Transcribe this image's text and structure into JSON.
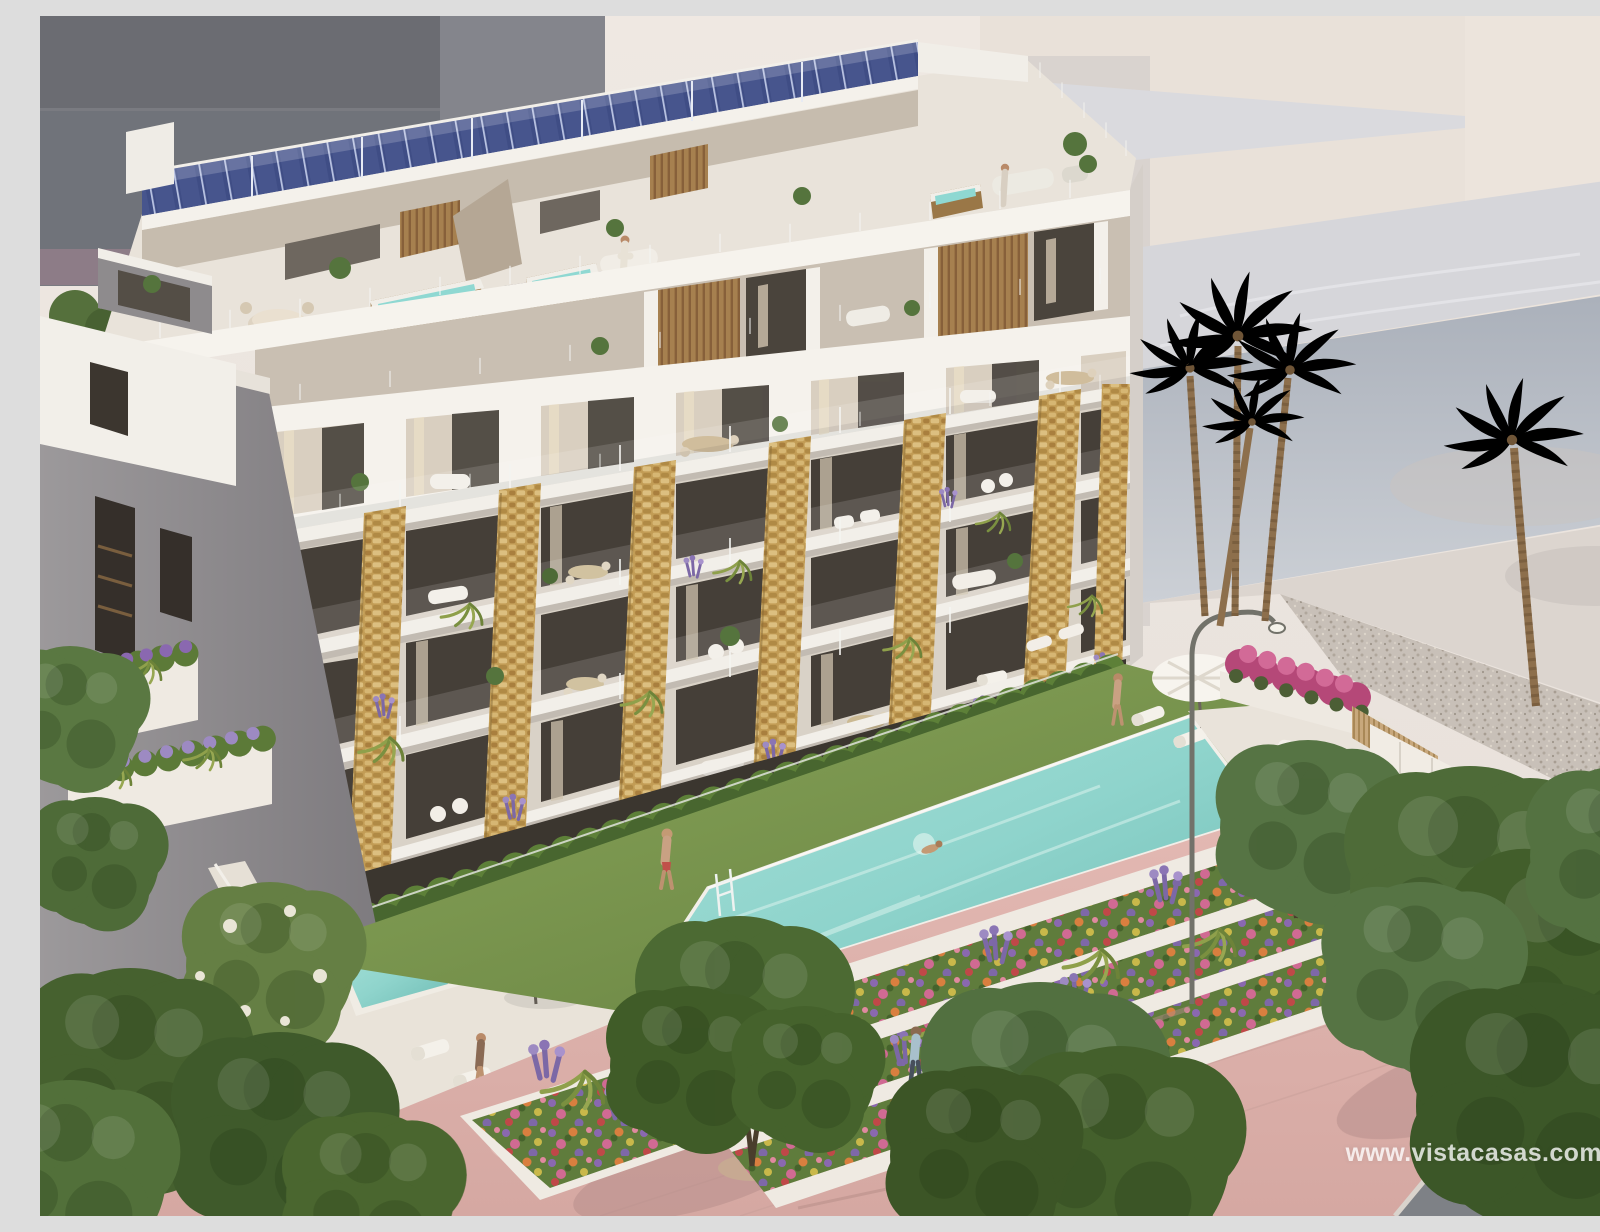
{
  "watermark": {
    "text": "www.vistacasas.com"
  },
  "palette": {
    "sky": "#ece5df",
    "bgDarkBuilding": "#7a7b81",
    "bgCream": "#e9e1d9",
    "roofMarble": "#d6d6da",
    "shadowFaceTop": "#aeb3bd",
    "shadowFaceBottom": "#ccd0d6",
    "plaza": "#dcd5cf",
    "gravel": "#c8c0b8",
    "buildingWhite": "#f5f2ec",
    "facadeWall": "#d9d2c7",
    "windowVoid": "#453f38",
    "stoneGold": "#c29c55",
    "solarBlue": "#3f4d85",
    "poolTurquoise": "#8fd4cc",
    "lawnGreen": "#7d9a52",
    "hedgeGreen": "#48662f",
    "promenadePink": "#dfb5b0",
    "roadGrey": "#7e8186",
    "treeGreen": "#4e6b38",
    "palmGreen": "#5d7c42",
    "bougainvillea": "#b54878",
    "lavender": "#8a74b4",
    "woodBrown": "#a6804f",
    "watermark": "rgba(255,255,255,0.78)"
  },
  "scene": {
    "type": "3d-architectural-render",
    "subject": "Modern seaside apartment block with rooftop solar panels and jacuzzi terraces, stone-clad balcony piers, communal lawn with infinity pool, terraced flower beds and a pink promenade with trees, palms and pedestrians",
    "elements": [
      "solar-panel-array",
      "rooftop-terraces",
      "jacuzzis",
      "penthouse-level",
      "stone-pillars",
      "balconies",
      "glass-railings",
      "hedge-gardens",
      "plunge-pools",
      "parasols",
      "sun-loungers",
      "infinity-pool",
      "swimmer",
      "lawn",
      "street-lamp",
      "flower-terraces",
      "promenade",
      "bicycle-rack",
      "pedestrians",
      "palm-trees",
      "promenade-trees",
      "background-buildings"
    ]
  }
}
